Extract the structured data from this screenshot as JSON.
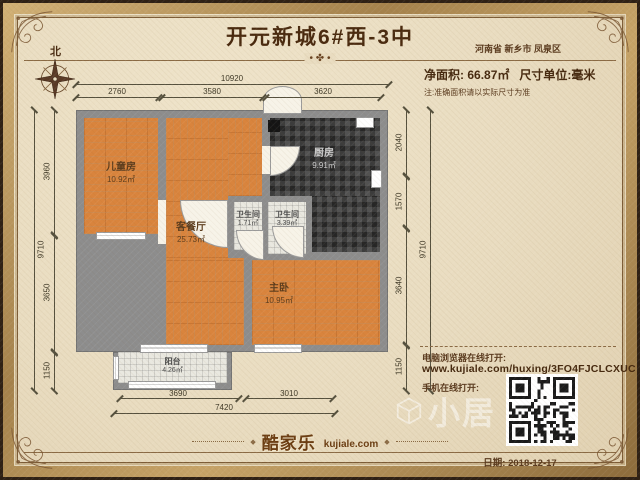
{
  "header": {
    "title": "开元新城6#西-3中",
    "location": "河南省 新乡市 凤泉区",
    "net_area_label": "净面积:",
    "net_area_value": "66.87㎡",
    "unit_text": "尺寸单位:毫米",
    "note": "注:准确面积请以实际尺寸为准",
    "compass_label": "北",
    "divider_ornament": "• ✤ •"
  },
  "rooms": [
    {
      "name": "儿童房",
      "area": "10.92㎡"
    },
    {
      "name": "客餐厅",
      "area": "25.73㎡"
    },
    {
      "name": "厨房",
      "area": "9.91㎡"
    },
    {
      "name": "卫生间",
      "area": "1.71㎡"
    },
    {
      "name": "卫生间",
      "area": "3.39㎡"
    },
    {
      "name": "主卧",
      "area": "10.95㎡"
    },
    {
      "name": "阳台",
      "area": "4.26㎡"
    }
  ],
  "dimensions": {
    "top_total": "10920",
    "top_segments": [
      "2760",
      "3580",
      "3620"
    ],
    "left_total": "9710",
    "left_segments": [
      "3960",
      "3650",
      "1150"
    ],
    "right_total": "9710",
    "right_segments": [
      "2040",
      "1570",
      "3640",
      "1150"
    ],
    "bottom_segments": [
      "3690",
      "3010"
    ],
    "bottom_total": "7420"
  },
  "footer": {
    "pc_label": "电脑浏览器在线打开:",
    "pc_url": "www.kujiale.com/huxing/3FO4FJCLCXUC",
    "mobile_label": "手机在线打开:",
    "logo_cn": "酷家乐",
    "logo_domain": "kujiale.com",
    "ornament": "◆",
    "date_label": "日期: 2018-12-17",
    "watermark": "小居"
  },
  "colors": {
    "paper": "#e9dcc0",
    "frame_gold": "#c7a468",
    "frame_dark": "#2e2014",
    "wall_gray": "#8d8d8d",
    "wood_floor": "#d9843d",
    "kitchen_tile": "#3e3e3e",
    "bath_tile": "#e9e8e0",
    "text_brown": "#5a3a1e"
  }
}
